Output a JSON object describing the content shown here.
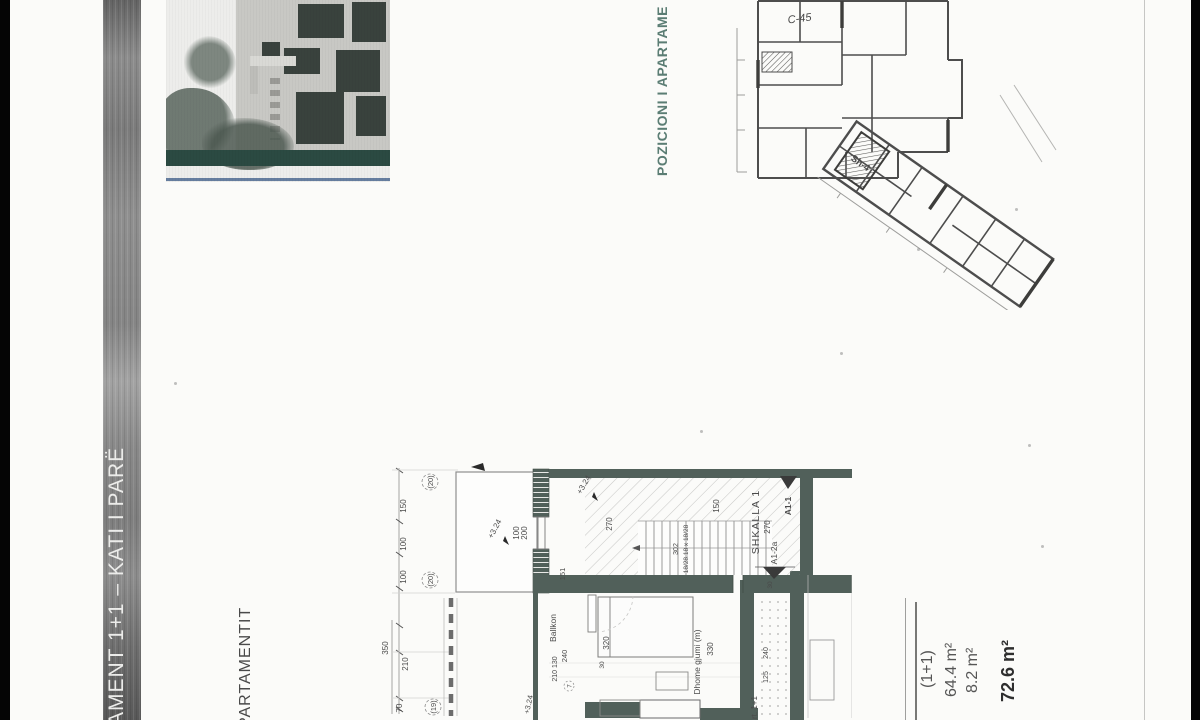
{
  "sheet": {
    "binding_title": "AMENT 1+1 – KATI I PARË",
    "position_title": "POZICIONI I APARTAME",
    "plan_caption": "PARTAMENTIT"
  },
  "key_plan": {
    "unit_label": "C-45",
    "stair_label": "Sh-4"
  },
  "plan": {
    "stair_name": "SHKALLA 1",
    "stair_note": "18/28.18 x 18/28",
    "walk_dim": "302",
    "section_a11": "A1-1",
    "section_a12a": "A1-2a",
    "level_mark": "+3.24",
    "room_balcony": "Ballkon",
    "room_bedroom": "Dhome gjumi (m)",
    "apartment_partial": "rt. 1+1",
    "dims": {
      "left": [
        "150",
        "100",
        "100",
        "350",
        "210",
        "70"
      ],
      "grid_bubbles": [
        "(20)",
        "(20)",
        "(19)"
      ],
      "window": [
        "200",
        "100"
      ],
      "hall": [
        "270",
        "151",
        "150",
        "270",
        "30"
      ],
      "corridor": [
        "240",
        "125"
      ],
      "bedroom": [
        "320",
        "330"
      ],
      "balcony": [
        "240",
        "210 130",
        "30",
        "7"
      ]
    }
  },
  "summary": {
    "unit_type": "(1+1)",
    "area_net": "64.4 m²",
    "area_balcony": "8.2 m²",
    "area_total": "72.6 m²"
  },
  "colors": {
    "wall": "#51605a",
    "accent_teal": "#5b7d74",
    "ink": "#4a4a4a"
  }
}
